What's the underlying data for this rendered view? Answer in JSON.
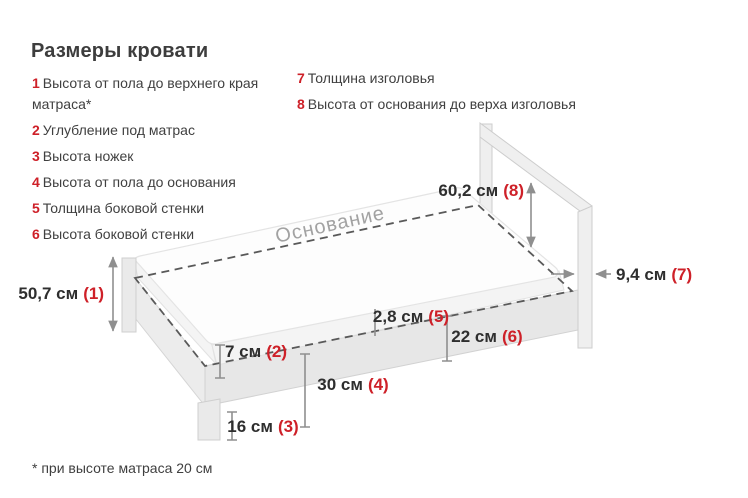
{
  "title": "Размеры кровати",
  "legend": {
    "left": [
      {
        "num": "1",
        "text": "Высота от пола до верхнего края матраса*"
      },
      {
        "num": "2",
        "text": "Углубление под матрас"
      },
      {
        "num": "3",
        "text": "Высота ножек"
      },
      {
        "num": "4",
        "text": "Высота от пола до основания"
      },
      {
        "num": "5",
        "text": "Толщина боковой стенки"
      },
      {
        "num": "6",
        "text": "Высота боковой стенки"
      }
    ],
    "right": [
      {
        "num": "7",
        "text": "Толщина изголовья"
      },
      {
        "num": "8",
        "text": "Высота от основания до верха изголовья"
      }
    ]
  },
  "diagram": {
    "base_label": "Основание",
    "dims": {
      "d1": {
        "value": "50,7 см",
        "ref": "(1)"
      },
      "d2": {
        "value": "7 см",
        "ref": "(2)"
      },
      "d3": {
        "value": "16 см",
        "ref": "(3)"
      },
      "d4": {
        "value": "30 см",
        "ref": "(4)"
      },
      "d5": {
        "value": "2,8 см",
        "ref": "(5)"
      },
      "d6": {
        "value": "22 см",
        "ref": "(6)"
      },
      "d7": {
        "value": "9,4 см",
        "ref": "(7)"
      },
      "d8": {
        "value": "60,2 см",
        "ref": "(8)"
      }
    }
  },
  "footnote": "* при высоте матраса 20 см",
  "colors": {
    "accent_red": "#ce2028",
    "text_dark": "#3d3d3d",
    "dim_line_gray": "#8f8f8f",
    "dash_gray": "#595959",
    "base_label_gray": "#a2a2a2"
  }
}
